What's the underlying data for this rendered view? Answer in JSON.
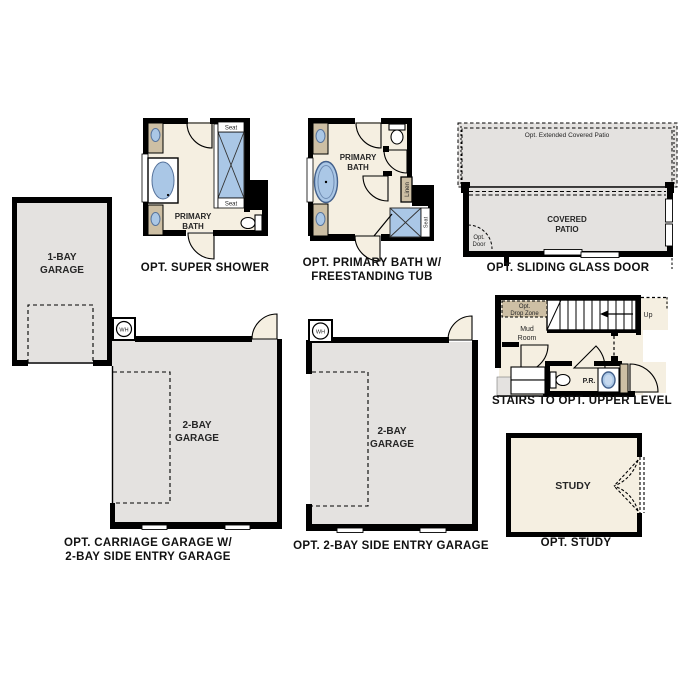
{
  "colors": {
    "wall": "#000000",
    "floor": "#f5efe1",
    "surface": "#e4e2e0",
    "counter": "#cdbfa4",
    "fixture": "#aac7e6",
    "label": "#262626"
  },
  "plans": {
    "super_shower": {
      "caption": "OPT. SUPER SHOWER",
      "room_line1": "PRIMARY",
      "room_line2": "BATH",
      "seat_top": "Seat",
      "seat_bottom": "Seat"
    },
    "primary_bath_tub": {
      "caption_line1": "OPT. PRIMARY BATH W/",
      "caption_line2": "FREESTANDING TUB",
      "room_line1": "PRIMARY",
      "room_line2": "BATH",
      "linen": "Linen",
      "seat": "Seat"
    },
    "sliding_glass_door": {
      "caption": "OPT. SLIDING GLASS DOOR",
      "extended_patio": "Opt. Extended Covered Patio",
      "patio_line1": "COVERED",
      "patio_line2": "PATIO",
      "opt_door_line1": "Opt.",
      "opt_door_line2": "Door"
    },
    "stairs_upper_level": {
      "caption": "STAIRS TO OPT. UPPER LEVEL",
      "drop_zone_line1": "Opt.",
      "drop_zone_line2": "Drop Zone",
      "mud_line1": "Mud",
      "mud_line2": "Room",
      "up": "Up",
      "powder": "P.R."
    },
    "carriage_garage": {
      "caption_line1": "OPT. CARRIAGE GARAGE W/",
      "caption_line2": "2-BAY SIDE ENTRY GARAGE",
      "garage1_line1": "1-BAY",
      "garage1_line2": "GARAGE",
      "garage2_line1": "2-BAY",
      "garage2_line2": "GARAGE",
      "water_heater": "WH"
    },
    "side_entry_garage": {
      "caption": "OPT. 2-BAY SIDE ENTRY GARAGE",
      "garage_line1": "2-BAY",
      "garage_line2": "GARAGE",
      "water_heater": "WH"
    },
    "study": {
      "caption": "OPT. STUDY",
      "room": "STUDY"
    }
  }
}
